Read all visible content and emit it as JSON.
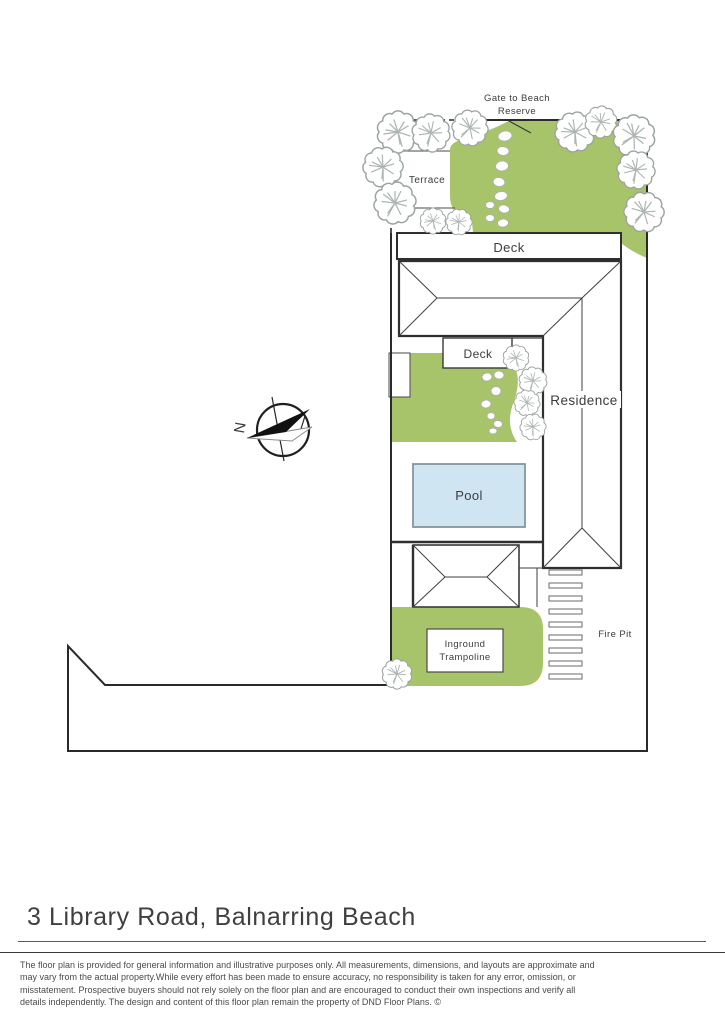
{
  "plan": {
    "labels": {
      "gate_line1": "Gate to Beach",
      "gate_line2": "Reserve",
      "terrace": "Terrace",
      "deck_upper": "Deck",
      "deck_lower": "Deck",
      "residence": "Residence",
      "pool": "Pool",
      "trampoline_line1": "Inground",
      "trampoline_line2": "Trampoline",
      "fire_pit": "Fire Pit",
      "compass_north": "N"
    },
    "colors": {
      "garden_green": "#a8c46b",
      "pool_fill": "#cfe5f2",
      "pool_border": "#85959e",
      "pool_label": "#5d7d98",
      "outline": "#2f2f2f",
      "tree_outline": "#9aa3a0"
    }
  },
  "footer": {
    "title": "3 Library Road, Balnarring Beach",
    "disclaimer_lines": [
      "The floor plan is provided for general information and illustrative purposes only. All measurements, dimensions, and layouts are approximate and",
      "may vary from the actual property.While every effort has been made to ensure accuracy, no responsibility is taken for any error, omission, or",
      "misstatement. Prospective buyers should not rely solely on the floor plan and are encouraged to conduct their own inspections and verify all",
      "details independently. The design and content of this floor plan remain the property of DND Floor Plans. ©"
    ]
  }
}
